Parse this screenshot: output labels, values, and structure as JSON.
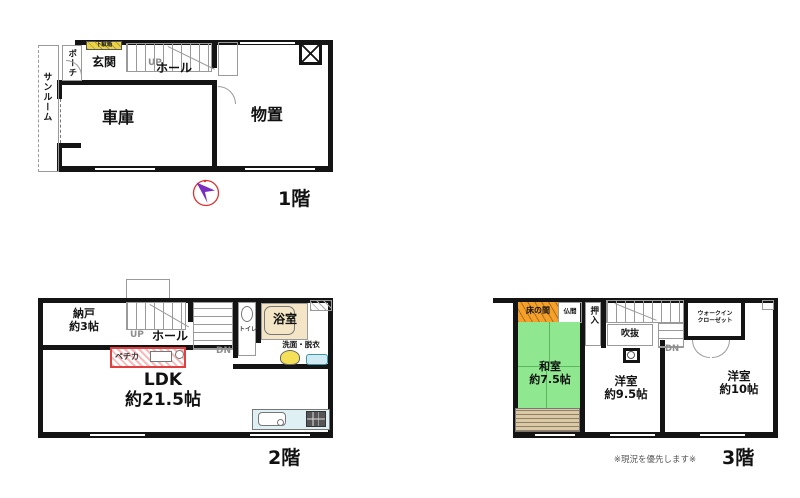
{
  "note": "※現況を優先します※",
  "floor1": {
    "label": "1階",
    "rooms": {
      "sunroom": "サンルーム",
      "porch": "ポーチ",
      "getabako": "下駄箱",
      "genkan": "玄関",
      "up": "UP",
      "hall": "ホール",
      "garage": "車庫",
      "storage": "物置"
    }
  },
  "floor2": {
    "label": "2階",
    "rooms": {
      "nando": "納戸\n約3帖",
      "up": "UP",
      "hall": "ホール",
      "dn": "DN",
      "toilet": "トイレ",
      "bath": "浴室",
      "washroom": "洗面・脱衣",
      "pechka": "ペチカ",
      "ldk": "LDK\n約21.5帖"
    }
  },
  "floor3": {
    "label": "3階",
    "rooms": {
      "tokonoma": "床の間",
      "butsuma": "仏間",
      "oshiire": "押入",
      "fukinuke": "吹抜",
      "dn": "DN",
      "wic": "ウォークイン\nクローゼット",
      "washitsu": "和室\n約7.5帖",
      "yoshitsu_95": "洋室\n約9.5帖",
      "yoshitsu_10": "洋室\n約10帖"
    }
  },
  "icons": {
    "compass": "north-arrow"
  },
  "colors": {
    "wall": "#141414",
    "tatami_green": "#8fe88f",
    "tokonoma_orange": "#f5a02b",
    "bath_beige": "#f3e5c5",
    "shoebox_yellow": "#e8d44a",
    "pechka_red": "#e04040",
    "kitchen_blue": "#dff0f4",
    "strip_tan": "#d9c9a7",
    "compass_purple": "#7a2fc0",
    "compass_ring_red": "#e03030"
  }
}
